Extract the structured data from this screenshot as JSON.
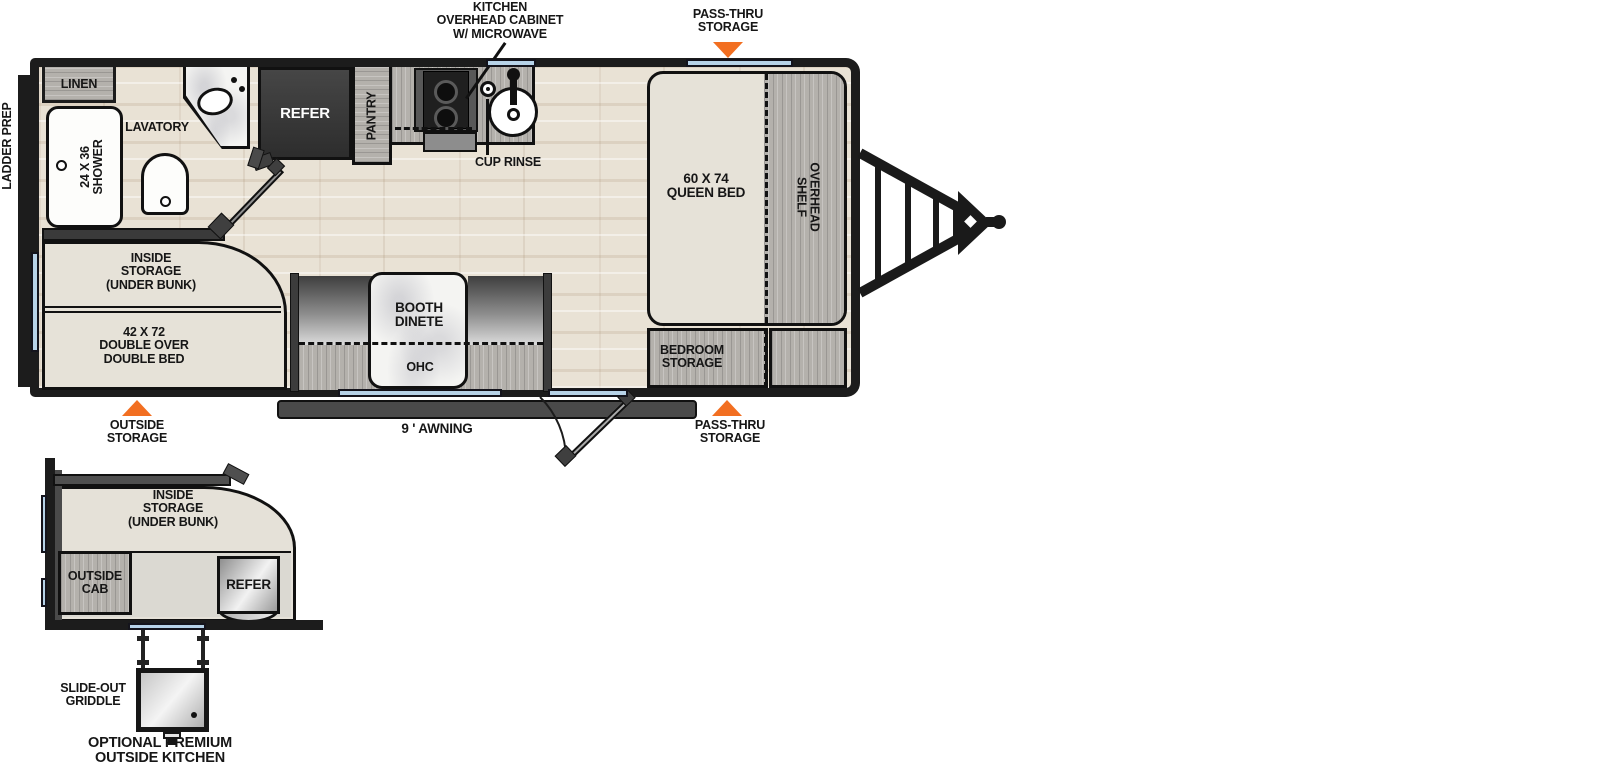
{
  "colors": {
    "accent_orange": "#F26F21",
    "window_blue": "#B7D3E8",
    "wall_black": "#1C1C1C"
  },
  "floorplan": {
    "exterior": {
      "ladder_prep": "LADDER PREP",
      "kitchen_overhead_cabinet": [
        "KITCHEN",
        "OVERHEAD CABINET",
        "W/ MICROWAVE"
      ],
      "pass_thru_top": [
        "PASS-THRU",
        "STORAGE"
      ],
      "pass_thru_bottom": [
        "PASS-THRU",
        "STORAGE"
      ],
      "outside_storage": [
        "OUTSIDE",
        "STORAGE"
      ],
      "awning": "9 ' AWNING"
    },
    "rooms": {
      "linen": "LINEN",
      "shower": [
        "24 X 36",
        "SHOWER"
      ],
      "lavatory": "LAVATORY",
      "refer": "REFER",
      "pantry": "PANTRY",
      "cup_rinse": "CUP RINSE",
      "queen_bed": [
        "60 X 74",
        "QUEEN BED"
      ],
      "overhead_shelf": [
        "OVERHEAD",
        "SHELF"
      ],
      "bedroom_storage": [
        "BEDROOM",
        "STORAGE"
      ],
      "inside_storage": [
        "INSIDE",
        "STORAGE",
        "(UNDER BUNK)"
      ],
      "double_bed": [
        "42 X 72",
        "DOUBLE OVER",
        "DOUBLE BED"
      ],
      "booth_dinette": [
        "BOOTH",
        "DINETE"
      ],
      "ohc": "OHC"
    }
  },
  "inset": {
    "inside_storage": [
      "INSIDE",
      "STORAGE",
      "(UNDER BUNK)"
    ],
    "outside_cab": [
      "OUTSIDE",
      "CAB"
    ],
    "refer": "REFER",
    "slide_out_griddle": [
      "SLIDE-OUT",
      "GRIDDLE"
    ],
    "caption": [
      "OPTIONAL PREMIUM",
      "OUTSIDE KITCHEN"
    ]
  }
}
